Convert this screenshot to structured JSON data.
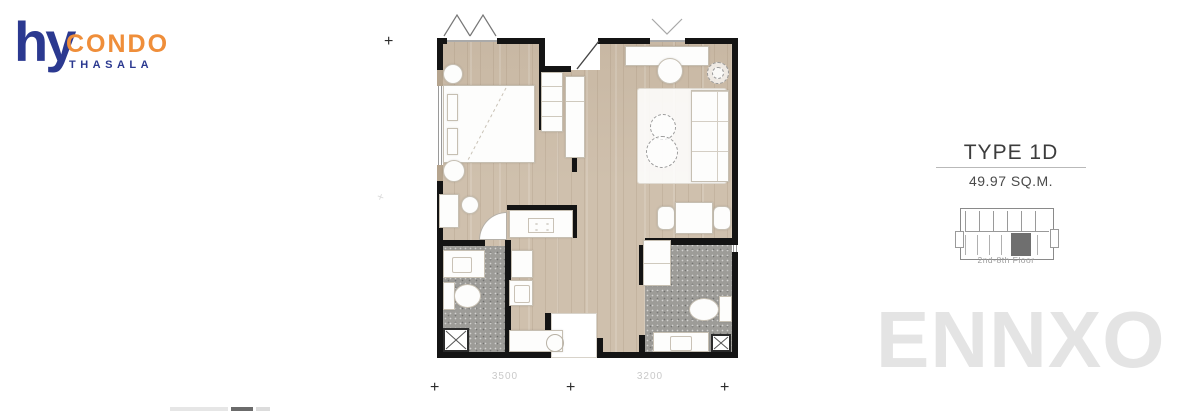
{
  "logo": {
    "mark": "hy",
    "brand": "CONDO",
    "sub_brand": "THASALA"
  },
  "unit_info": {
    "type": "TYPE 1D",
    "area": "49.97 SQ.M.",
    "floors": "2nd-8th Floor"
  },
  "plan": {
    "dimension_labels": {
      "left": "3500",
      "right": "3200"
    },
    "marker_symbol": "+"
  },
  "watermark": "ENNXO",
  "colors": {
    "brand_navy": "#2b3990",
    "brand_orange": "#ef8e3a",
    "wall_black": "#141414",
    "wood_floor": "#cfc0ad",
    "tile_gray": "#9d9c98",
    "keyplan_highlight": "#6f6f6f",
    "watermark_gray": "#e4e4e4"
  }
}
